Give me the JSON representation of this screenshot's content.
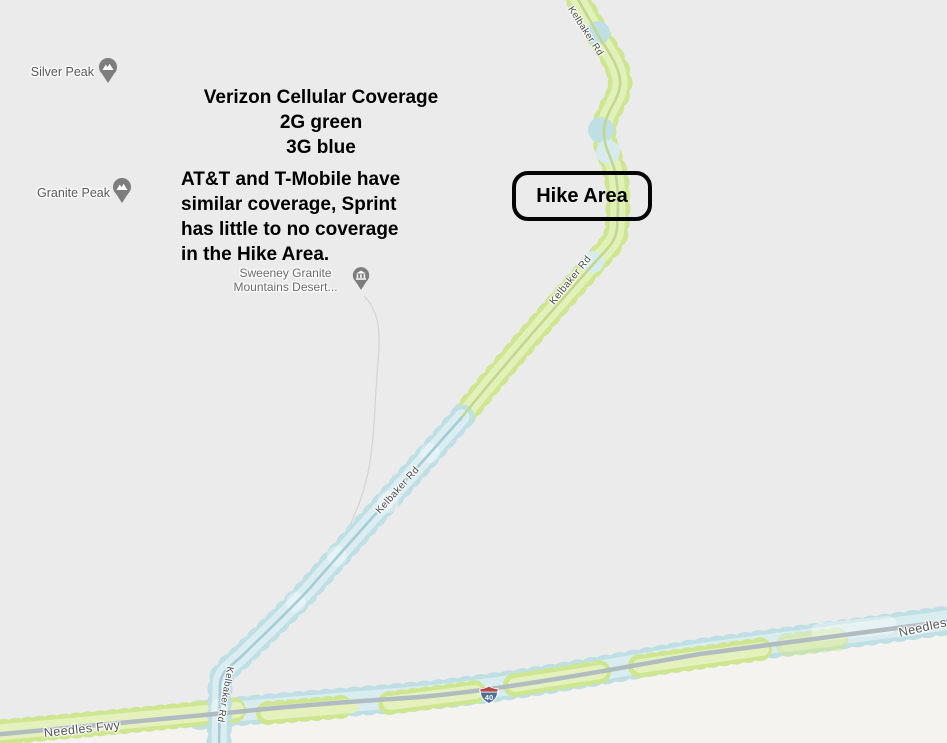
{
  "map": {
    "background_color": "#ebebeb",
    "terrain_fill": "#f4f3f0",
    "coverage_colors": {
      "green_2g": "#cde68f",
      "blue_3g": "#bedfe4"
    },
    "labels": {
      "silver_peak": "Silver Peak",
      "granite_peak": "Granite Peak",
      "sweeney_line1": "Sweeney Granite",
      "sweeney_line2": "Mountains Desert...",
      "kelbaker_rd": "Kelbaker Rd",
      "needles_fwy": "Needles Fwy",
      "interstate_number": "40"
    }
  },
  "annotations": {
    "title": "Verizon Cellular Coverage",
    "legend_2g": "2G green",
    "legend_3g": "3G blue",
    "body": "AT&T and T-Mobile have\nsimilar coverage, Sprint\nhas little to no coverage\nin the Hike Area.",
    "hike_area_label": "Hike Area"
  }
}
